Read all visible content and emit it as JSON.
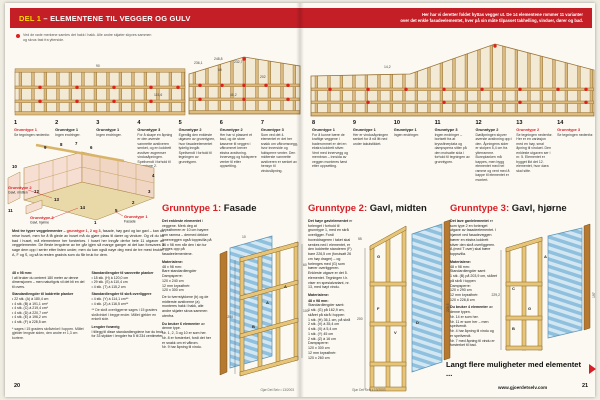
{
  "banner": {
    "highlight": "DEL 1",
    "title": " – ELEMENTENE TIL VEGGER OG GULV",
    "right_line1": "Her har vi deretter foldet hyttas vegger ut. De 14 elementene rommer 11 varianter",
    "right_line2": "over det enkle fasadeelementet, hver på sin måte tilpasset takhelling, vinduer, dører og bad."
  },
  "note": {
    "text": "Ved de røde merkene samles det hakk i hakk. Alle andre skjøter skyves sammen og skrus fast fra ytterside."
  },
  "colors": {
    "banner_red": "#c41f26",
    "highlight_yellow": "#ffd800",
    "accent_red": "#d61f26",
    "timber": "#ddbb7e",
    "timber_dark": "#9a7334",
    "panel_blue": "#8fc0de"
  },
  "wall_dims": {
    "left": [
      "90",
      "115,6"
    ],
    "gable": [
      "236,1",
      "248,8",
      "232,7",
      "60",
      "202",
      "48,2"
    ],
    "right": [
      "14,2"
    ]
  },
  "elements": [
    {
      "num": "1",
      "type": "Grunntype 1",
      "text": "Se tegningen nedenfor."
    },
    {
      "num": "2",
      "type": "Grunntype 1",
      "text": "Ingen endringer."
    },
    {
      "num": "3",
      "type": "Grunntype 1",
      "text": "Ingen endringer."
    },
    {
      "num": "4",
      "type": "Grunntype 3",
      "text": "For å skape en åpning er den øverste vannrette avstiveren senket, og en loddrett avstiver avgrenser vindusåpningen. Speilvendt i forhold til grunntype 2."
    },
    {
      "num": "5",
      "type": "Grunntype 2",
      "text": "Egentlig den enkleste utgaven av grunntypen, hvor fasadeelementet tydelig inngår. Speilvendt i forhold til tegningen av grunntypen."
    },
    {
      "num": "6",
      "type": "Grunntype 2",
      "text": "Her har vi plassert et bad, og de store kassene til veggen i våtrommet krever ekstra avstivning. Innervegg og fuktsperre venter til etter oppsetting."
    },
    {
      "num": "7",
      "type": "Grunntype 3",
      "text": "Som ved det 4. elementet er det her snakk om våtromsvegg, hvor innerside og fuktsperre venter. Den midterste vannrette avstiveren er senket av hensyn til vindusåpning."
    },
    {
      "num": "8",
      "type": "Grunntype 1",
      "text": "For å kunne bære de kraftige veggene i baderommet er det en ekstra loddrett stiver. Vent med innervegg og membran – innsida av veggen monteres først etter oppsetting."
    },
    {
      "num": "9",
      "type": "Grunntype 1",
      "text": "Her er vindusåpningen senket for å nå litt ned under takutstikket."
    },
    {
      "num": "10",
      "type": "Grunntype 1",
      "text": "Ingen endringer."
    },
    {
      "num": "11",
      "type": "Grunntype 3",
      "text": "Ingen endringer – bortsett fra at kryssfinerplata og dampsperra sitter på den motsatte sida i forhold til tegningen av grunntypen."
    },
    {
      "num": "12",
      "type": "Grunntype 2",
      "text": "Døråpningen skyver øverste avstivning opp i den. Åpningens sider er stolpen 5,4 cm fra ytterramme. Bunnplanken må kappes, men bygg elementet med hel ramme og vent med å kappe til elementet er montert."
    },
    {
      "num": "13",
      "type": "Grunntype 2",
      "text": "Se tegningen nedenfor. Her er en variasjon med en høy, smal åpning til vinduet. Den enkleste utgaven ser i nr. 5. Elementet er bygget likt det 12. elementet, hvor døra skal sitte."
    },
    {
      "num": "14",
      "type": "Grunntype 3",
      "text": "Se tegningen nedenfor."
    }
  ],
  "house": {
    "numbers": [
      "1",
      "2",
      "3",
      "4",
      "5",
      "6",
      "7",
      "8",
      "9",
      "10",
      "11",
      "12",
      "13",
      "14"
    ],
    "labels": [
      {
        "title": "Grunntype 1",
        "sub": "Fasade"
      },
      {
        "title": "Grunntype 2",
        "sub": "Gavl, midten"
      },
      {
        "title": "Grunntype 3",
        "sub": "Gavl, hjørne"
      }
    ]
  },
  "intro": {
    "lead": "Med tre typer veggelementer – ",
    "lead_red": "grunntype 1, 2 og 3,",
    "body": " fasade, høy gavl og lav gavl – kan du reise huset, men for å få glede av huset må du gjøre plass til dører og vinduer. Og vil du ha bad i huset, må elementene her forsterkes. I huset her inngår derfor hele 11 utgaver av veggelementer. De fleste lengdene av tre går igjen så mange ganger at det kan forsvares å sage dem opp i serier etter listen under, men du kan også nøye deg med de tre mest brukte, A, F og S, og så ta resten gradvis som du får bruk for dem."
  },
  "cutlist": {
    "dim_title": "48 x 98 mm:",
    "dim_body": "I alt bruker du omtrent 180 meter av denne dimensjonen – men naturligvis vil det bli en del til overs.",
    "upright_title": "Standardlengder til loddrette planker",
    "upright_items": [
      "• 22 stk. (A) à 180,4 cm",
      "• 4 stk. (B) à 191,1 cm*",
      "• 4 stk. (C) à 219,4 cm*",
      "• 4 stk. (D) à 220,7 cm*",
      "• 4 stk. (E) à 196,2 cm",
      "• 4 stk. (F) à 228,5 cm"
    ],
    "footnote1": "* sages i 15 graders skråvinkel i toppen. Målet gjelder lengste siden, den andre er 1,3 cm kortere.",
    "horiz_title": "Standardlengder til vannrette planker",
    "horiz_items": [
      "• 18 stk. (H) à 120,0 cm",
      "• 29 stk. (S) à 110,4 cm",
      "• 4 stk. (T) à 115,2 cm"
    ],
    "slant_title": "Standardlengder til skrå overliggere",
    "slant_items": [
      "• 4 stk. (Y) à 114,1 cm**",
      "• 4 stk. (Z) à 116,5 cm**"
    ],
    "footnote2": "** De skrå overliggerne sages i 15 graders skråvinkel i begge ender. Målet gjelder en enkelt side.",
    "other_title": "Lengder forøvrig",
    "other_body": "I tillegg til disse standardlengdene har du bruk for 33 stykker i lengder fra 5 til 234 centimeter."
  },
  "sections": {
    "g1": {
      "title_red": "Grunntype 1:",
      "title_black": " Fasade",
      "lead": "Det enkleste elementet",
      "body": "i veggene. Merk deg at kryssfineren er 10 cm høyere enn ramma – dermed dekker innerveggen også toppsvilla på 36 x 98 mm når den i sin tur legges opp på fasadeelementene.",
      "mat_title": "Materialene:",
      "mat_items": [
        "48 x 98 mm:",
        "Bare standardlengder",
        "Dampsperre:",
        "120 x 240 cm",
        "12 mm kryssfinér:",
        "120 x 300 cm"
      ],
      "note": "De to tverrstykkene (b) og de midterste avstiverne (a) monteres hakk i hakk, alle andre skjøter skrus sammen utenfra.",
      "use_lead": "Du bruker 6 elementer",
      "use_rest": " av denne type.",
      "use_items": [
        "Nr. 1, 2, 3 og 10 er som her.",
        "Nr. 8 er forsterket, fordi det her er snakk om et våtrom.",
        "Nr. 9 har åpning til vindu."
      ]
    },
    "g2": {
      "title_red": "Grunntype 2:",
      "title_black": " Gavl, midten",
      "lead": "Det høye gavlelementet",
      "body": "er forlenget i forhold til grunntype 1, med en skrå overligger. Fordi hoveddrageren i taket skal senkes ned i elementet, er den loddrette standeren (F) bare 226,5 cm (forutsatt 26 cm høy drager) – og forlenges med (G) som bærer overliggeren. Enkleste utgave er det 5. elementet. Tegningen t.h. viser en spesialvariant, nr. 13, med høyt vindu.",
      "mat_title": "Materialene:",
      "mat_sub": "48 x 98 mm:",
      "mat_sub2": "Standardlengder samt:",
      "mat_items": [
        "1 stk. (G) på 162,9 cm, skåret på skrå i toppen",
        "1 stk. (H) 36,1 cm, på skrå",
        "2 stk. (V) à 35,4 cm",
        "4 stk. (X) à 5,4 cm",
        "1 stk. (Y) 45 cm",
        "2 stk. (Z) à 16 cm"
      ],
      "mat_items2": [
        "Dampsperre:",
        "120 x 300 cm",
        "12 mm kryssfinér:",
        "120 x 260 cm"
      ]
    },
    "g3": {
      "title_red": "Grunntype 3:",
      "title_black": " Gavl, hjørne",
      "lead": "Det lave gavlelementet",
      "body": "er som type 2 en forlenget utgave av fasadeelementet. I hjørnet ved fasadeveggen bærer en ekstra loddrett stiver den skrå overliggeren. A (med T over) skal bære toppsvilla.",
      "mat_title": "Materialene:",
      "mat_items": [
        "48 x 98 mm:",
        "Standardlengder samt",
        "1 stk. (B) på 203,9 cm, skåret på skrå i toppen",
        "Dampsperre:",
        "120 x 290 cm",
        "12 mm kryssfinér:",
        "120 x 228,8 cm"
      ],
      "use_lead": "Du bruker 4 elementer",
      "use_rest": " av denne typen.",
      "use_items": [
        "Nr. 14 er som her.",
        "Nr. 11 er som her – men speilvendt.",
        "Nr. 4 har åpning til vindu og er speilvendt.",
        "Nr. 7 med åpning til vindu er forsterket til bad."
      ]
    }
  },
  "drawings": {
    "g1": {
      "letters": [
        "A",
        "B",
        "A"
      ],
      "dims": [
        "10",
        "200",
        "60",
        "100"
      ]
    },
    "g2": {
      "letters": [
        "G",
        "F",
        "V",
        "D"
      ],
      "dims": [
        "55",
        "200",
        "226,5"
      ]
    },
    "g3": {
      "letters": [
        "A",
        "C",
        "G",
        "B"
      ],
      "dims": [
        "229,2",
        "197"
      ]
    }
  },
  "teaser": {
    "text": "Langt flere muligheter med elementet ..."
  },
  "footer": {
    "page_left": "20",
    "issue_left": "Gjør Det Selv • 13/2003",
    "issue_right": "Gjør Det Selv • 13/2003",
    "url": "www.gjoerdetselv.com",
    "page_right": "21"
  }
}
